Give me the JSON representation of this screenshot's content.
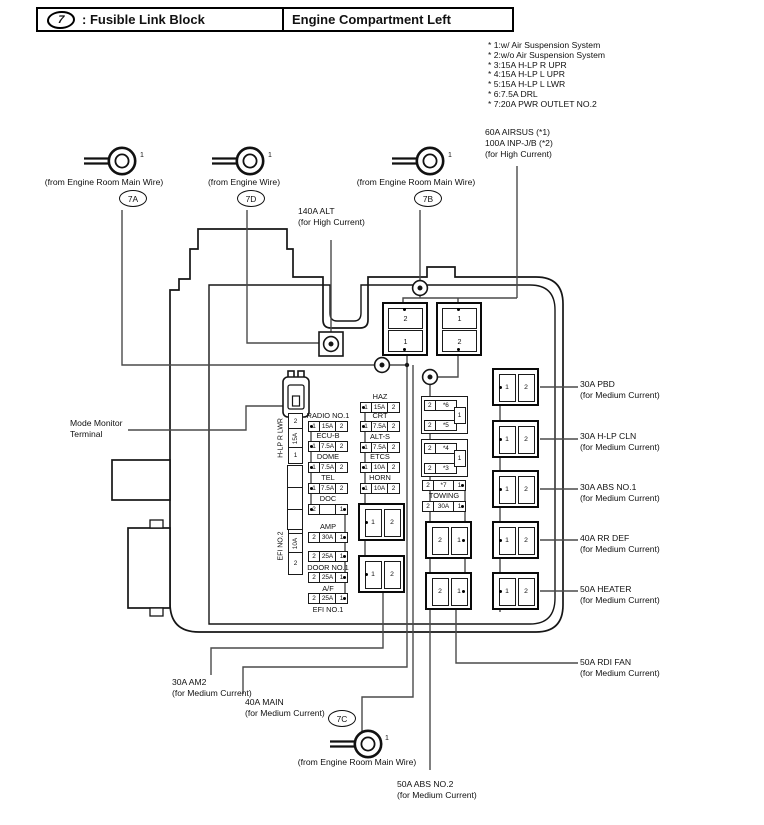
{
  "header": {
    "icon_glyph": "7",
    "left_title": ": Fusible Link Block",
    "right_title": "Engine Compartment Left"
  },
  "notes": {
    "lines": [
      "* 1:w/ Air Suspension System",
      "* 2:w/o Air Suspension System",
      "* 3:15A H-LP R UPR",
      "* 4:15A H-LP L UPR",
      "* 5:15A H-LP L LWR",
      "* 6:7.5A DRL",
      "* 7:20A PWR OUTLET NO.2"
    ]
  },
  "terminals": [
    {
      "id": "7A",
      "wire_label": "(from Engine Room Main Wire)",
      "pin": "1"
    },
    {
      "id": "7D",
      "wire_label": "(from Engine Wire)",
      "pin": "1"
    },
    {
      "id": "7B",
      "wire_label": "(from Engine Room Main Wire)",
      "pin": "1"
    },
    {
      "id": "7C",
      "wire_label": "(from Engine Room Main Wire)",
      "pin": "1"
    }
  ],
  "callouts": {
    "alt": {
      "line1": "140A ALT",
      "line2": "(for High Current)"
    },
    "airsus": {
      "line1": "60A AIRSUS (*1)",
      "line2": "100A INP-J/B (*2)",
      "line3": "(for High Current)"
    },
    "mode": {
      "line1": "Mode Monitor",
      "line2": "Terminal"
    }
  },
  "right_labels": [
    {
      "name": "30A PBD",
      "sub": "(for Medium Current)"
    },
    {
      "name": "30A H-LP CLN",
      "sub": "(for Medium Current)"
    },
    {
      "name": "30A ABS NO.1",
      "sub": "(for Medium Current)"
    },
    {
      "name": "40A RR DEF",
      "sub": "(for Medium Current)"
    },
    {
      "name": "50A HEATER",
      "sub": "(for Medium Current)"
    },
    {
      "name": "50A RDI FAN",
      "sub": "(for Medium Current)"
    }
  ],
  "bottom_labels": [
    {
      "name": "30A AM2",
      "sub": "(for Medium Current)"
    },
    {
      "name": "40A MAIN",
      "sub": "(for Medium Current)"
    },
    {
      "name": "50A ABS NO.2",
      "sub": "(for Medium Current)"
    }
  ],
  "fuse_rows": {
    "col2": [
      {
        "label": "RADIO NO.1",
        "label_pos": "above",
        "cells": [
          "1",
          "15A",
          "2"
        ],
        "dot": "left"
      },
      {
        "label": "ECU-B",
        "label_pos": "above",
        "cells": [
          "1",
          "7.5A",
          "2"
        ],
        "dot": "left"
      },
      {
        "label": "DOME",
        "label_pos": "above",
        "cells": [
          "1",
          "7.5A",
          "2"
        ],
        "dot": "left"
      },
      {
        "label": "TEL",
        "label_pos": "above",
        "cells": [
          "1",
          "7.5A",
          "2"
        ],
        "dot": "left"
      },
      {
        "label": "DOC",
        "label_pos": "above",
        "cells": [
          "2",
          "",
          "1"
        ],
        "dot": "both"
      },
      {
        "label": "AMP",
        "label_pos": "above",
        "cells": [
          "2",
          "30A",
          "1"
        ],
        "dot": "right"
      },
      {
        "label": "DOOR NO.1",
        "label_pos": "below",
        "cells": [
          "2",
          "25A",
          "1"
        ],
        "dot": "right"
      },
      {
        "label": "A/F",
        "label_pos": "below",
        "cells": [
          "2",
          "25A",
          "1"
        ],
        "dot": "right"
      },
      {
        "label": "EFI NO.1",
        "label_pos": "below",
        "cells": [
          "2",
          "25A",
          "1"
        ],
        "dot": "right"
      }
    ],
    "col3": [
      {
        "label": "HAZ",
        "label_pos": "above",
        "cells": [
          "1",
          "15A",
          "2"
        ],
        "dot": "left"
      },
      {
        "label": "CRT",
        "label_pos": "above",
        "cells": [
          "1",
          "7.5A",
          "2"
        ],
        "dot": "left"
      },
      {
        "label": "ALT-S",
        "label_pos": "above",
        "cells": [
          "1",
          "7.5A",
          "2"
        ],
        "dot": "left"
      },
      {
        "label": "ETCS",
        "label_pos": "above",
        "cells": [
          "1",
          "10A",
          "2"
        ],
        "dot": "left"
      },
      {
        "label": "HORN",
        "label_pos": "above",
        "cells": [
          "1",
          "10A",
          "2"
        ],
        "dot": "left"
      }
    ],
    "col4": [
      {
        "label": "",
        "label_pos": "none",
        "cells": [
          "2",
          "*7",
          "1"
        ],
        "dot": "right"
      },
      {
        "label": "TOWING",
        "label_pos": "above",
        "cells": [
          "2",
          "30A",
          "1"
        ],
        "dot": "right"
      }
    ]
  },
  "brackets": [
    {
      "rows": [
        [
          "2",
          "*6"
        ],
        [
          "2",
          "*5"
        ]
      ],
      "side_cell": "1"
    },
    {
      "rows": [
        [
          "2",
          "*4"
        ],
        [
          "2",
          "*3"
        ]
      ],
      "side_cell": "1"
    }
  ],
  "vertical_fuses": [
    {
      "label": "H-LP R LWR",
      "cells": [
        "2",
        "15A",
        "1"
      ]
    },
    {
      "label": "EFI NO.2",
      "cells": [
        "1",
        "10A",
        "2"
      ]
    }
  ],
  "big_boxes": [
    {
      "cells": [
        "2",
        "1"
      ]
    },
    {
      "cells": [
        "1",
        "2"
      ]
    }
  ],
  "cell_boxes": [
    {
      "id": "A1",
      "cells": [
        "1",
        "2"
      ],
      "dot": "left"
    },
    {
      "id": "A2",
      "cells": [
        "1",
        "2"
      ],
      "dot": "left"
    },
    {
      "id": "B1",
      "cells": [
        "2",
        "1"
      ],
      "dot": "right"
    },
    {
      "id": "B2",
      "cells": [
        "2",
        "1"
      ],
      "dot": "right"
    },
    {
      "id": "R1",
      "cells": [
        "1",
        "2"
      ],
      "dot": "left"
    },
    {
      "id": "R2",
      "cells": [
        "1",
        "2"
      ],
      "dot": "left"
    },
    {
      "id": "R3",
      "cells": [
        "1",
        "2"
      ],
      "dot": "left"
    },
    {
      "id": "R4",
      "cells": [
        "1",
        "2"
      ],
      "dot": "left"
    },
    {
      "id": "R5",
      "cells": [
        "1",
        "2"
      ],
      "dot": "left"
    }
  ]
}
